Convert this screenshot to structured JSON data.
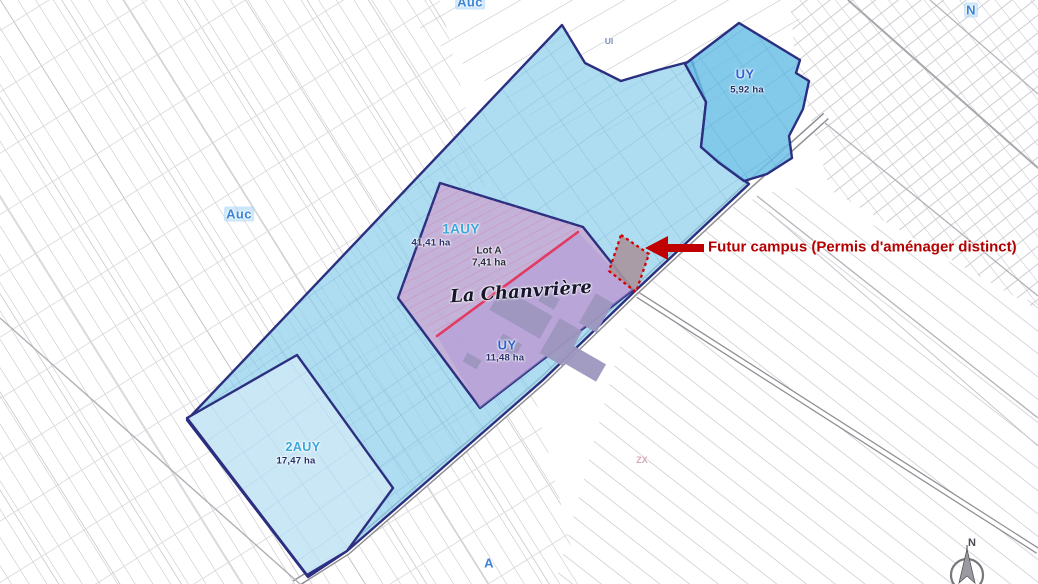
{
  "map": {
    "region_labels": {
      "auc_top": "Auc",
      "auc_left": "Auc",
      "ui_small": "UI",
      "a_bottom": "A",
      "zx_small": "ZX",
      "n_top": "N",
      "lieu_dit": "La Chanvrière"
    },
    "zones": {
      "auy1": {
        "code": "1AUY",
        "area": "41,41 ha"
      },
      "auy2": {
        "code": "2AUY",
        "area": "17,47 ha"
      },
      "uy_central": {
        "code": "UY",
        "area": "11,48 ha"
      },
      "uy_north": {
        "code": "UY",
        "area": "5,92 ha"
      },
      "lot_a": {
        "code": "Lot A",
        "area": "7,41 ha"
      }
    },
    "annotation": {
      "text": "Futur campus (Permis d'aménager distinct)",
      "color": "#b40000"
    },
    "compass": {
      "letter": "N"
    },
    "colors": {
      "zone_border": "#2c2f80",
      "zone_1auy": "#8fd0ec",
      "zone_2auy": "#cfe9f7",
      "zone_uy_north": "#6cc0e6",
      "zone_purple": "#c9a8d2",
      "zone_uy_central": "#b09ad8",
      "lot_divider_red": "#e23a60",
      "building_gray": "#9e97bf",
      "future_campus_fill": "#a9959e",
      "future_campus_border": "#d40000",
      "arrow_red": "#c00000"
    }
  }
}
